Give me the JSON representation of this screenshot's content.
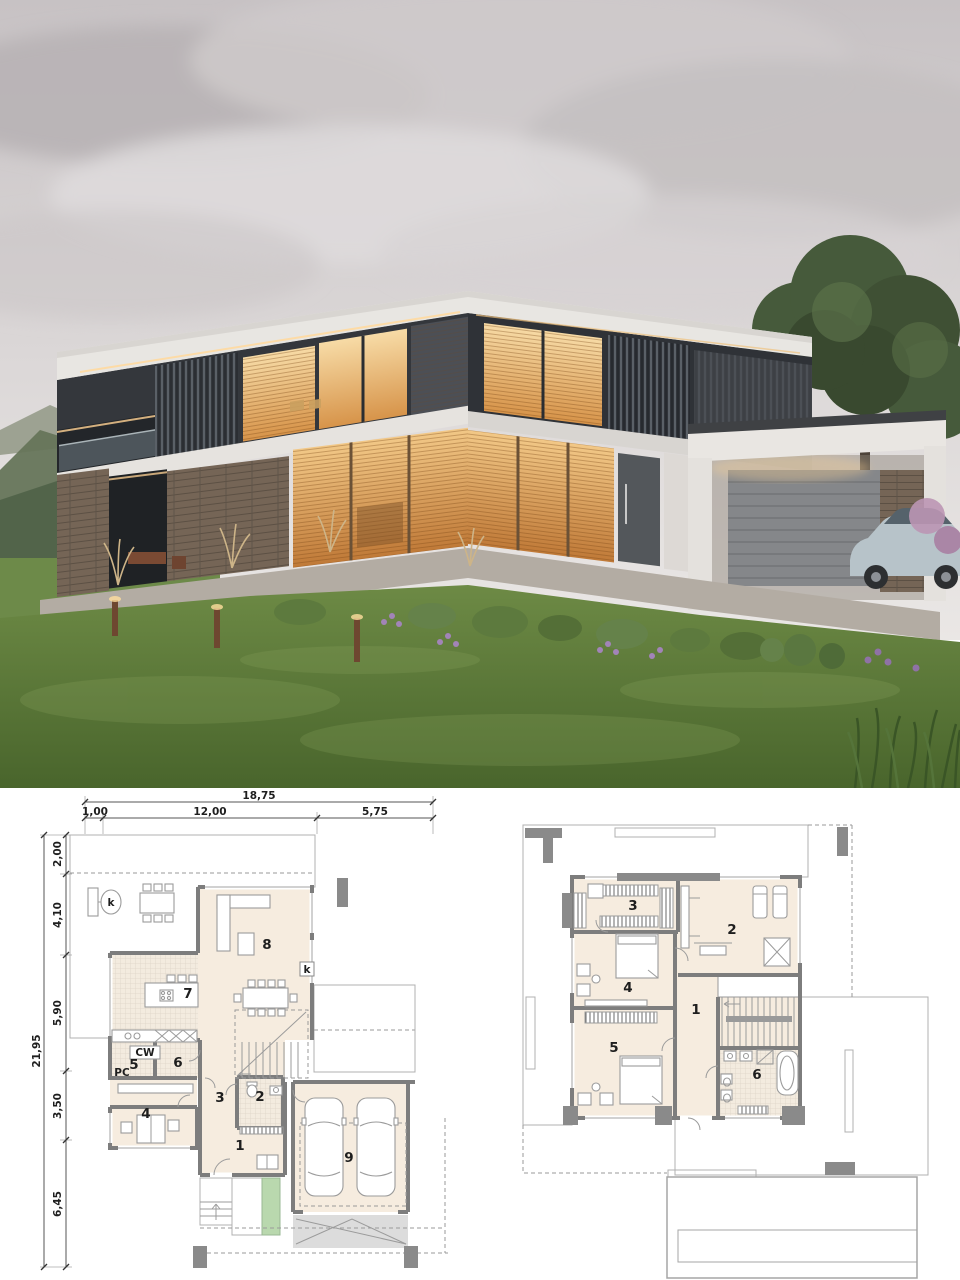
{
  "dimensions": {
    "total_width": "18,75",
    "width_segments": [
      "1,00",
      "12,00",
      "5,75"
    ],
    "total_depth": "21,95",
    "depth_segments": [
      "2,00",
      "4,10",
      "5,90",
      "3,50",
      "6,45"
    ]
  },
  "ground_floor": {
    "labels": {
      "r1": "1",
      "r2": "2",
      "r3": "3",
      "r4": "4",
      "r5": "5",
      "r6": "6",
      "r7": "7",
      "r8": "8",
      "r9": "9",
      "cw": "CW",
      "pc": "PC",
      "k_terrace": "k",
      "k_wall": "k"
    }
  },
  "upper_floor": {
    "labels": {
      "r1": "1",
      "r2": "2",
      "r3": "3",
      "r4": "4",
      "r5": "5",
      "r6": "6"
    }
  },
  "colors": {
    "room_fill": "#f6ecdf",
    "tiled_fill": "#f3ebdf",
    "terrace": "#d9d9d9",
    "wall": "#7d7d7d",
    "planter_green": "#b9d8ae",
    "warm_window": "#e8a95c",
    "house_dark": "#34373c",
    "house_white": "#e8e6e2",
    "lawn": "#5f7f3c",
    "sky": "#d6d2d3"
  }
}
